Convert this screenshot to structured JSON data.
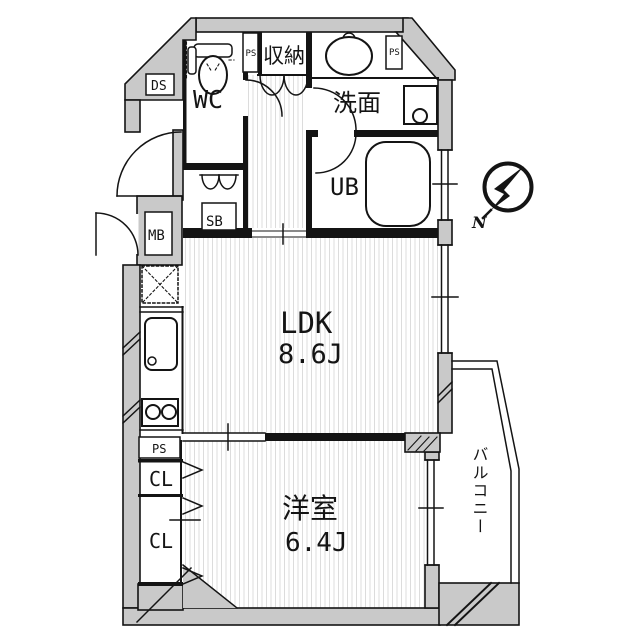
{
  "floorplan": {
    "title": "1LDK apartment floor plan",
    "labels": {
      "wc": "WC",
      "storage": "収納",
      "washroom": "洗面",
      "unit_bath": "UB",
      "ldk": "LDK",
      "ldk_size": "8.6J",
      "western_room": "洋室",
      "western_room_size": "6.4J",
      "balcony": "バルコニー",
      "closet_upper": "CL",
      "closet_lower": "CL",
      "meter_box": "MB",
      "shoe_box": "SB",
      "duct_space": "DS",
      "pipe_space_top": "PS",
      "pipe_space_right": "PS",
      "pipe_space_kitchen": "PS",
      "compass_north": "N"
    },
    "colors": {
      "wall_fill": "#c9c9c9",
      "line": "#141414",
      "floor_stripe": "#dcdcdc",
      "background": "#ffffff"
    }
  }
}
